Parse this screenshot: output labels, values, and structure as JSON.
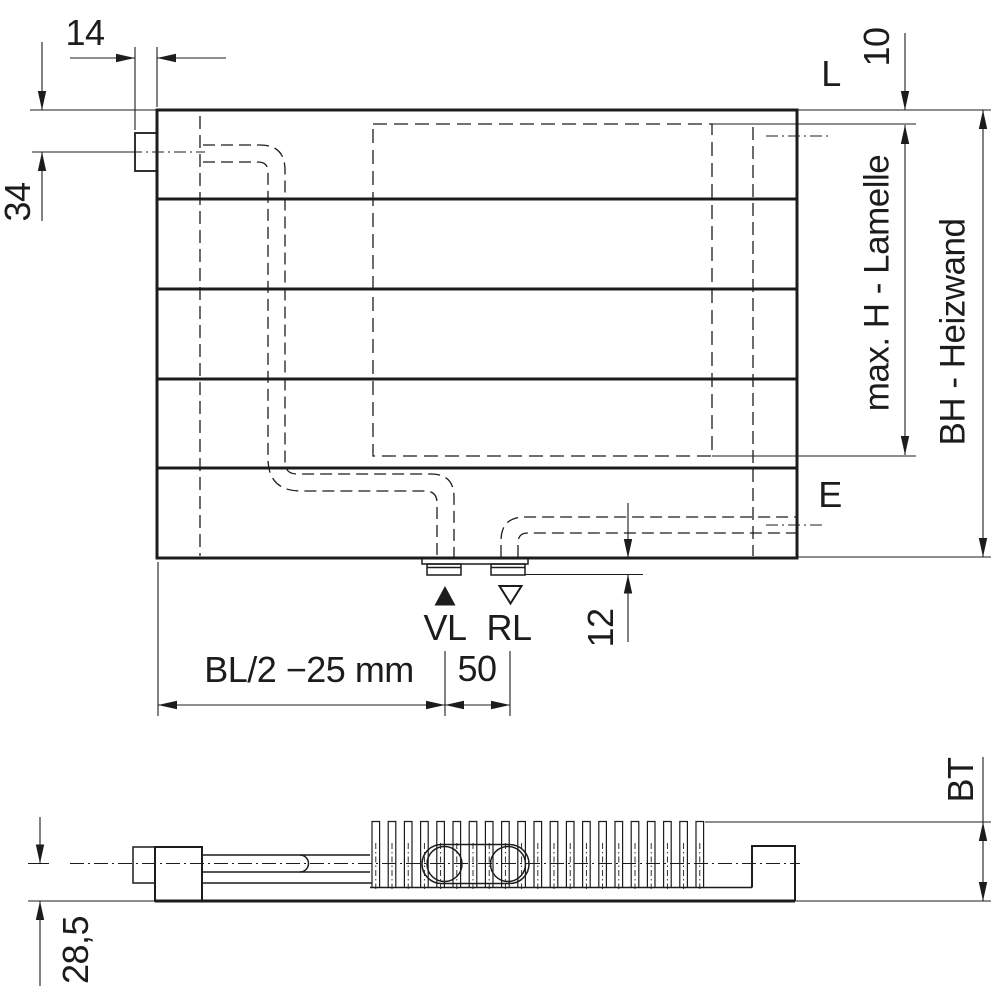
{
  "drawing": {
    "colors": {
      "line": "#1c1c1c",
      "background": "#ffffff"
    },
    "dimensions": {
      "bracket_tab_width": "14",
      "bracket_axis_from_top": "34",
      "lamelle_inset_top": "10",
      "lamelle_max_height": "max. H - Lamelle",
      "build_height": "BH - Heizwand",
      "connection_protrusion": "12",
      "connection_spacing": "50",
      "connection_offset_left": "BL/2 −25 mm",
      "build_depth": "BT",
      "pipe_axis_from_wall": "28,5"
    },
    "markers": {
      "top_right": "L",
      "bottom_right": "E",
      "supply": "VL",
      "return": "RL"
    }
  }
}
